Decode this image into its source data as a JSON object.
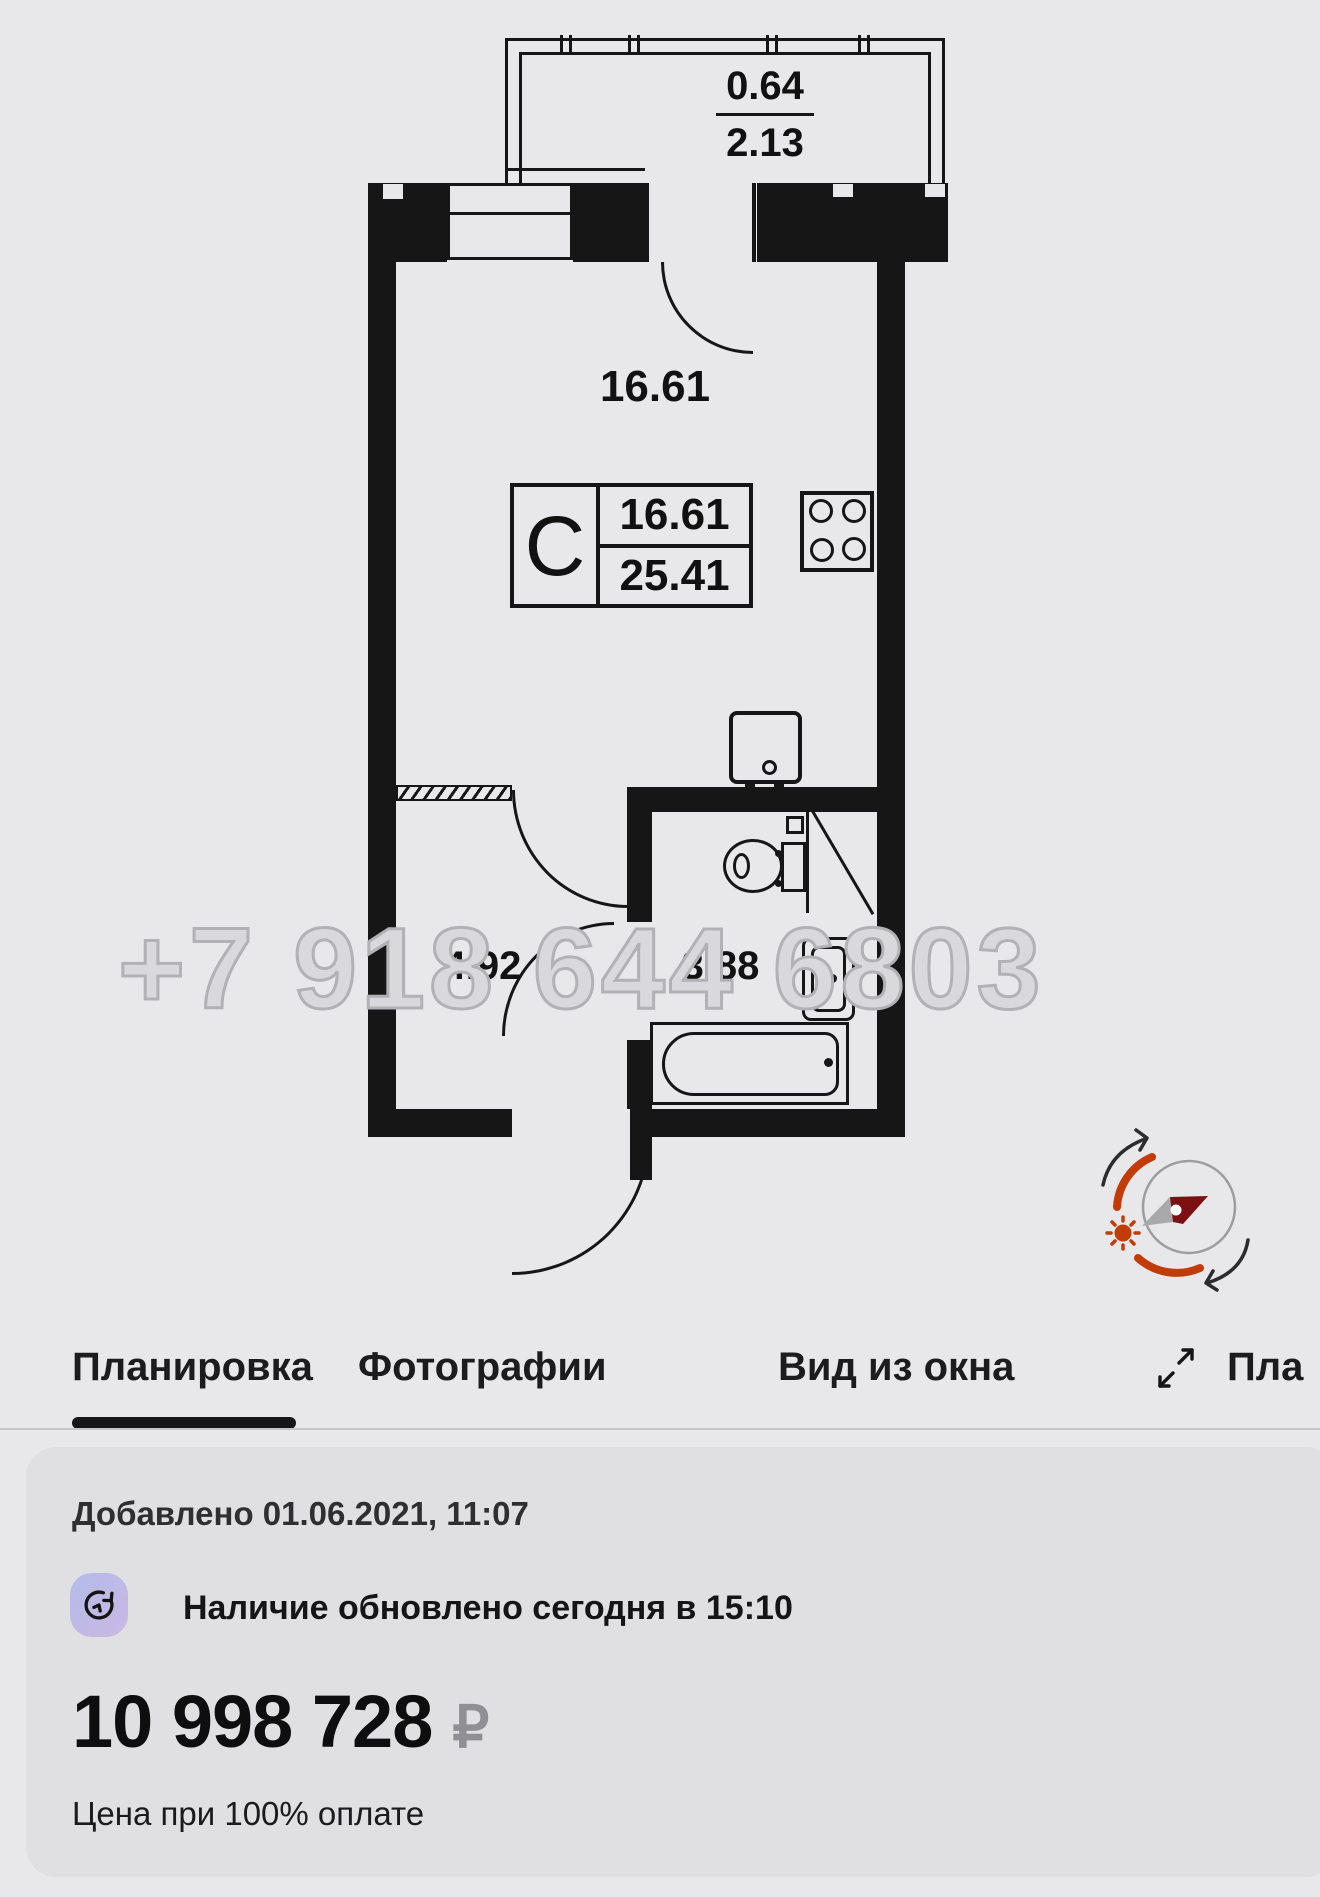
{
  "colors": {
    "accent_orange": "#c23c08",
    "needle_red": "#7c1012",
    "wall_black": "#161616",
    "watermark_gray": "#b2b2b6"
  },
  "plan": {
    "watermark": "+7 918 644 6803",
    "balcony": {
      "area_reduced": "0.64",
      "area_full": "2.13"
    },
    "room_label": "16.61",
    "unit_box": {
      "type_letter": "C",
      "area_living": "16.61",
      "area_total": "25.41"
    },
    "hallway_label": "4.92",
    "bathroom_label": "3.88"
  },
  "tabs": {
    "items": [
      {
        "label": "Планировка",
        "active": true
      },
      {
        "label": "Фотографии",
        "active": false
      },
      {
        "label": "Вид из окна",
        "active": false
      },
      {
        "label": "Пла",
        "active": false
      }
    ]
  },
  "card": {
    "added_line": "Добавлено 01.06.2021, 11:07",
    "availability_line": "Наличие обновлено сегодня в 15:10",
    "price": "10 998 728",
    "currency_symbol": "₽",
    "price_note": "Цена при 100% оплате"
  }
}
